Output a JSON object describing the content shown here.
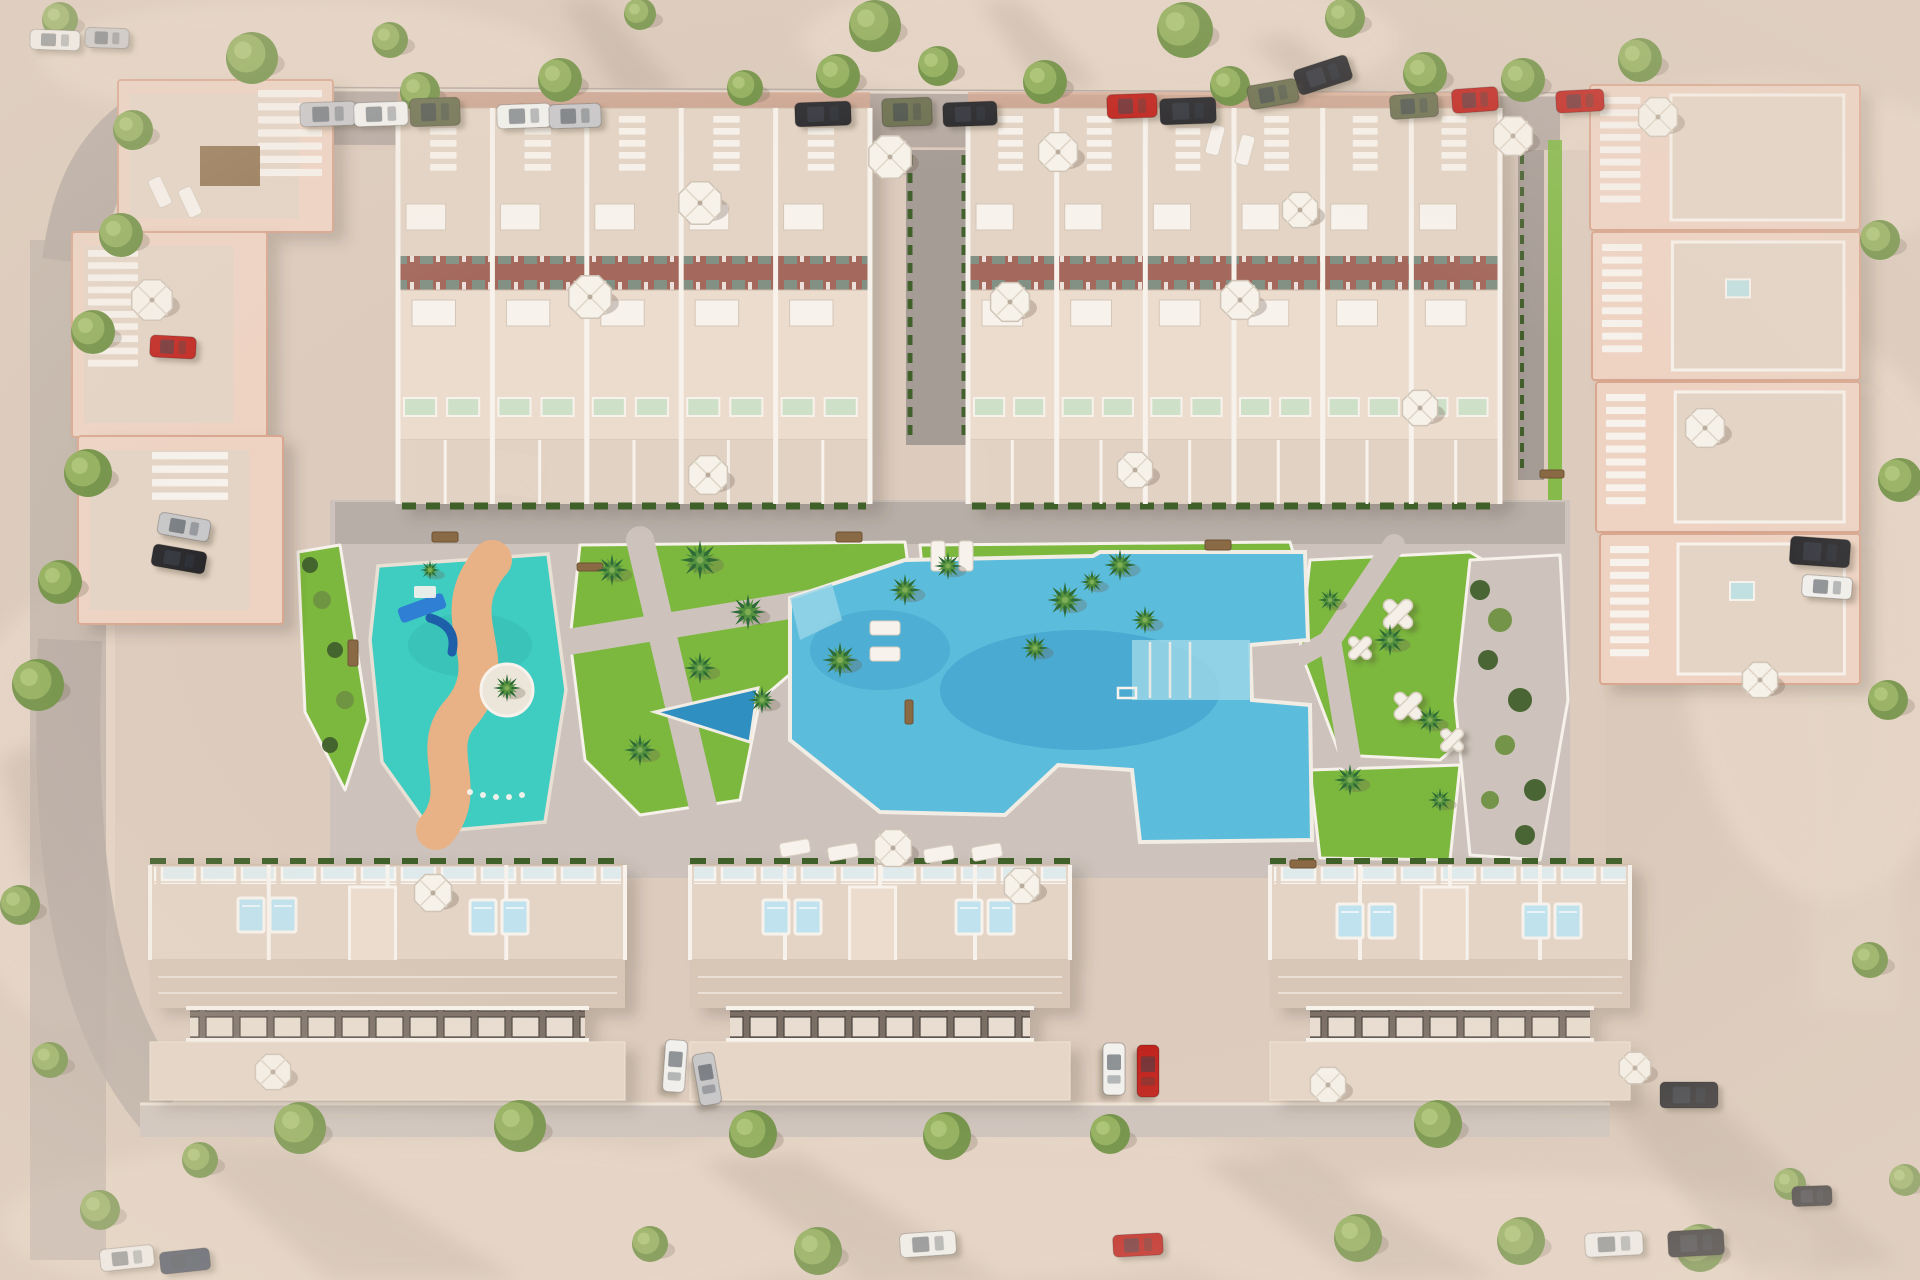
{
  "scene": {
    "title": "Aerial 3D render of a residential development with central pool, kids splash park, lawns and perimeter streets",
    "type": "architectural-visualization",
    "visible_text": ""
  },
  "palette": {
    "sand": "#dbcabb",
    "sand_light": "#ecdccc",
    "road": "#b5a9a2",
    "road_dark": "#a69c96",
    "pavement": "#cdc3bc",
    "block": "#ddccbe",
    "terrace": "#e4d4c5",
    "terrace_light": "#ecdccd",
    "wall": "#eed3c3",
    "wall_edge": "#d9a68f",
    "white": "#f7f2ec",
    "brick": "#a4685c",
    "glass": "#dfeaec",
    "lawn": "#7cb83e",
    "lawn_dark": "#69a431",
    "hedge": "#41602c",
    "bush_light": "#6f9242",
    "pool": "#5cbcdc",
    "pool_dark": "#2f8fc0",
    "pool_light": "#9ad6e8",
    "kids_pool": "#3fccc1",
    "kids_path": "#e9b286",
    "slide": "#2f7fd4",
    "tree": "#8fae58",
    "tree_dark": "#6d8f41",
    "tree_light": "#aac573",
    "planter": "#4d5138",
    "shadow": "#6f6054",
    "wood": "#8a6a45",
    "car_white": "#f2f1ee",
    "car_silver": "#c7c7c9",
    "car_black": "#26262a",
    "car_red": "#c0221c",
    "car_olive": "#6c7050",
    "car_navy": "#3a4558"
  },
  "rowhouse_clusters": [
    {
      "x": 398,
      "y": 108,
      "w": 472,
      "units": 5
    },
    {
      "x": 968,
      "y": 108,
      "w": 532,
      "units": 6
    }
  ],
  "apartment_buildings": [
    {
      "x": 118,
      "y": 80,
      "w": 215,
      "h": 152,
      "stair": [
        258,
        90,
        64,
        92
      ],
      "pergola": [
        200,
        146,
        60,
        40
      ]
    },
    {
      "x": 72,
      "y": 232,
      "w": 195,
      "h": 205,
      "stair": [
        88,
        250,
        50,
        122
      ],
      "pergola": null
    },
    {
      "x": 78,
      "y": 436,
      "w": 205,
      "h": 188,
      "stair": [
        152,
        452,
        76,
        54
      ],
      "pergola": null
    }
  ],
  "side_houses": [
    {
      "x": 1590,
      "y": 85,
      "w": 270,
      "h": 145,
      "skylight": false
    },
    {
      "x": 1592,
      "y": 232,
      "w": 268,
      "h": 148,
      "skylight": true
    },
    {
      "x": 1596,
      "y": 382,
      "w": 264,
      "h": 150,
      "skylight": false
    },
    {
      "x": 1600,
      "y": 534,
      "w": 260,
      "h": 150,
      "skylight": true
    }
  ],
  "bottom_blocks": [
    {
      "x": 150,
      "y": 865,
      "w": 475
    },
    {
      "x": 690,
      "y": 865,
      "w": 380
    },
    {
      "x": 1270,
      "y": 865,
      "w": 360
    }
  ],
  "rooftop_pool_pairs": [
    {
      "x": 238,
      "y": 898
    },
    {
      "x": 470,
      "y": 900
    },
    {
      "x": 763,
      "y": 900
    },
    {
      "x": 956,
      "y": 900
    },
    {
      "x": 1337,
      "y": 904
    },
    {
      "x": 1523,
      "y": 904
    }
  ],
  "trees": [
    {
      "x": 252,
      "y": 58,
      "r": 26
    },
    {
      "x": 390,
      "y": 40,
      "r": 18
    },
    {
      "x": 875,
      "y": 26,
      "r": 26
    },
    {
      "x": 938,
      "y": 66,
      "r": 20
    },
    {
      "x": 1185,
      "y": 30,
      "r": 28
    },
    {
      "x": 1345,
      "y": 18,
      "r": 20
    },
    {
      "x": 640,
      "y": 14,
      "r": 16
    },
    {
      "x": 1640,
      "y": 60,
      "r": 22
    },
    {
      "x": 60,
      "y": 20,
      "r": 18
    },
    {
      "x": 133,
      "y": 130,
      "r": 20
    },
    {
      "x": 420,
      "y": 92,
      "r": 20
    },
    {
      "x": 560,
      "y": 80,
      "r": 22
    },
    {
      "x": 745,
      "y": 88,
      "r": 18
    },
    {
      "x": 838,
      "y": 76,
      "r": 22
    },
    {
      "x": 1045,
      "y": 82,
      "r": 22
    },
    {
      "x": 1230,
      "y": 86,
      "r": 20
    },
    {
      "x": 1425,
      "y": 74,
      "r": 22
    },
    {
      "x": 1523,
      "y": 80,
      "r": 22
    },
    {
      "x": 121,
      "y": 235,
      "r": 22
    },
    {
      "x": 93,
      "y": 332,
      "r": 22
    },
    {
      "x": 88,
      "y": 473,
      "r": 24
    },
    {
      "x": 60,
      "y": 582,
      "r": 22
    },
    {
      "x": 38,
      "y": 685,
      "r": 26
    },
    {
      "x": 20,
      "y": 905,
      "r": 20
    },
    {
      "x": 50,
      "y": 1060,
      "r": 18
    },
    {
      "x": 1880,
      "y": 240,
      "r": 20
    },
    {
      "x": 1900,
      "y": 480,
      "r": 22
    },
    {
      "x": 1888,
      "y": 700,
      "r": 20
    },
    {
      "x": 1870,
      "y": 960,
      "r": 18
    },
    {
      "x": 300,
      "y": 1128,
      "r": 26
    },
    {
      "x": 520,
      "y": 1126,
      "r": 26
    },
    {
      "x": 753,
      "y": 1134,
      "r": 24
    },
    {
      "x": 947,
      "y": 1136,
      "r": 24
    },
    {
      "x": 1110,
      "y": 1134,
      "r": 20
    },
    {
      "x": 1438,
      "y": 1124,
      "r": 24
    },
    {
      "x": 200,
      "y": 1160,
      "r": 18
    },
    {
      "x": 650,
      "y": 1244,
      "r": 18
    },
    {
      "x": 818,
      "y": 1251,
      "r": 24
    },
    {
      "x": 1358,
      "y": 1238,
      "r": 24
    },
    {
      "x": 1521,
      "y": 1241,
      "r": 24
    },
    {
      "x": 1700,
      "y": 1248,
      "r": 24
    },
    {
      "x": 1790,
      "y": 1184,
      "r": 16
    },
    {
      "x": 100,
      "y": 1210,
      "r": 20
    },
    {
      "x": 1905,
      "y": 1180,
      "r": 16
    }
  ],
  "palms": [
    {
      "x": 612,
      "y": 570,
      "r": 16
    },
    {
      "x": 700,
      "y": 560,
      "r": 20
    },
    {
      "x": 748,
      "y": 612,
      "r": 18
    },
    {
      "x": 700,
      "y": 668,
      "r": 16
    },
    {
      "x": 762,
      "y": 700,
      "r": 14
    },
    {
      "x": 640,
      "y": 750,
      "r": 16
    },
    {
      "x": 840,
      "y": 660,
      "r": 18
    },
    {
      "x": 905,
      "y": 590,
      "r": 16
    },
    {
      "x": 948,
      "y": 566,
      "r": 14
    },
    {
      "x": 1120,
      "y": 565,
      "r": 16
    },
    {
      "x": 1065,
      "y": 600,
      "r": 18
    },
    {
      "x": 1035,
      "y": 648,
      "r": 14
    },
    {
      "x": 1092,
      "y": 582,
      "r": 12
    },
    {
      "x": 1145,
      "y": 620,
      "r": 14
    },
    {
      "x": 1390,
      "y": 640,
      "r": 16
    },
    {
      "x": 1430,
      "y": 720,
      "r": 14
    },
    {
      "x": 1350,
      "y": 780,
      "r": 16
    },
    {
      "x": 1440,
      "y": 800,
      "r": 12
    },
    {
      "x": 507,
      "y": 688,
      "r": 14
    },
    {
      "x": 430,
      "y": 570,
      "r": 10
    },
    {
      "x": 1330,
      "y": 600,
      "r": 12
    }
  ],
  "umbrellas": [
    {
      "x": 700,
      "y": 203,
      "r": 23
    },
    {
      "x": 890,
      "y": 157,
      "r": 23
    },
    {
      "x": 1058,
      "y": 152,
      "r": 21
    },
    {
      "x": 1010,
      "y": 302,
      "r": 21
    },
    {
      "x": 590,
      "y": 297,
      "r": 23
    },
    {
      "x": 708,
      "y": 475,
      "r": 21
    },
    {
      "x": 1240,
      "y": 300,
      "r": 21
    },
    {
      "x": 1135,
      "y": 470,
      "r": 19
    },
    {
      "x": 1420,
      "y": 408,
      "r": 19
    },
    {
      "x": 1513,
      "y": 136,
      "r": 21
    },
    {
      "x": 1300,
      "y": 210,
      "r": 19
    },
    {
      "x": 1658,
      "y": 117,
      "r": 21
    },
    {
      "x": 1705,
      "y": 428,
      "r": 21
    },
    {
      "x": 1760,
      "y": 680,
      "r": 19
    },
    {
      "x": 433,
      "y": 893,
      "r": 20
    },
    {
      "x": 1022,
      "y": 886,
      "r": 19
    },
    {
      "x": 893,
      "y": 848,
      "r": 20
    },
    {
      "x": 273,
      "y": 1072,
      "r": 19
    },
    {
      "x": 1328,
      "y": 1085,
      "r": 19
    },
    {
      "x": 1635,
      "y": 1068,
      "r": 17
    },
    {
      "x": 152,
      "y": 300,
      "r": 22
    }
  ],
  "cars": [
    {
      "x": 300,
      "y": 102,
      "w": 56,
      "h": 24,
      "a": -2,
      "c": "silver"
    },
    {
      "x": 354,
      "y": 102,
      "w": 54,
      "h": 24,
      "a": -2,
      "c": "white"
    },
    {
      "x": 410,
      "y": 98,
      "w": 50,
      "h": 28,
      "a": -2,
      "c": "olive"
    },
    {
      "x": 497,
      "y": 104,
      "w": 54,
      "h": 24,
      "a": -2,
      "c": "white"
    },
    {
      "x": 549,
      "y": 104,
      "w": 52,
      "h": 24,
      "a": -2,
      "c": "silver"
    },
    {
      "x": 795,
      "y": 102,
      "w": 56,
      "h": 24,
      "a": -2,
      "c": "black"
    },
    {
      "x": 882,
      "y": 98,
      "w": 50,
      "h": 28,
      "a": -2,
      "c": "olive"
    },
    {
      "x": 943,
      "y": 102,
      "w": 54,
      "h": 24,
      "a": -2,
      "c": "black"
    },
    {
      "x": 1107,
      "y": 94,
      "w": 50,
      "h": 24,
      "a": -2,
      "c": "red"
    },
    {
      "x": 1160,
      "y": 98,
      "w": 56,
      "h": 26,
      "a": -2,
      "c": "black"
    },
    {
      "x": 1295,
      "y": 62,
      "w": 56,
      "h": 26,
      "a": -18,
      "c": "black"
    },
    {
      "x": 1248,
      "y": 82,
      "w": 50,
      "h": 24,
      "a": -10,
      "c": "olive"
    },
    {
      "x": 1390,
      "y": 94,
      "w": 48,
      "h": 24,
      "a": -4,
      "c": "olive"
    },
    {
      "x": 1452,
      "y": 88,
      "w": 46,
      "h": 24,
      "a": -4,
      "c": "red"
    },
    {
      "x": 1556,
      "y": 90,
      "w": 48,
      "h": 22,
      "a": -3,
      "c": "red"
    },
    {
      "x": 30,
      "y": 30,
      "w": 50,
      "h": 20,
      "a": 2,
      "c": "white"
    },
    {
      "x": 85,
      "y": 28,
      "w": 44,
      "h": 20,
      "a": 2,
      "c": "silver"
    },
    {
      "x": 150,
      "y": 336,
      "w": 46,
      "h": 22,
      "a": 3,
      "c": "red"
    },
    {
      "x": 158,
      "y": 516,
      "w": 52,
      "h": 22,
      "a": 10,
      "c": "silver"
    },
    {
      "x": 152,
      "y": 548,
      "w": 54,
      "h": 22,
      "a": 10,
      "c": "black"
    },
    {
      "x": 1790,
      "y": 538,
      "w": 60,
      "h": 28,
      "a": 4,
      "c": "black"
    },
    {
      "x": 1802,
      "y": 576,
      "w": 50,
      "h": 22,
      "a": 4,
      "c": "white"
    },
    {
      "x": 649,
      "y": 1055,
      "w": 52,
      "h": 22,
      "a": 94,
      "c": "white"
    },
    {
      "x": 681,
      "y": 1068,
      "w": 52,
      "h": 22,
      "a": 80,
      "c": "silver"
    },
    {
      "x": 1088,
      "y": 1058,
      "w": 52,
      "h": 22,
      "a": 90,
      "c": "white"
    },
    {
      "x": 1122,
      "y": 1060,
      "w": 52,
      "h": 22,
      "a": 90,
      "c": "red"
    },
    {
      "x": 1660,
      "y": 1082,
      "w": 58,
      "h": 26,
      "a": 0,
      "c": "black"
    },
    {
      "x": 100,
      "y": 1247,
      "w": 54,
      "h": 22,
      "a": -6,
      "c": "white"
    },
    {
      "x": 160,
      "y": 1250,
      "w": 50,
      "h": 22,
      "a": -6,
      "c": "navy"
    },
    {
      "x": 900,
      "y": 1232,
      "w": 56,
      "h": 24,
      "a": -4,
      "c": "white"
    },
    {
      "x": 1113,
      "y": 1234,
      "w": 50,
      "h": 22,
      "a": -3,
      "c": "red"
    },
    {
      "x": 1585,
      "y": 1232,
      "w": 58,
      "h": 24,
      "a": -3,
      "c": "white"
    },
    {
      "x": 1668,
      "y": 1230,
      "w": 56,
      "h": 26,
      "a": -3,
      "c": "black"
    },
    {
      "x": 1792,
      "y": 1186,
      "w": 40,
      "h": 20,
      "a": -2,
      "c": "black"
    }
  ],
  "x_tables": [
    {
      "x": 1398,
      "y": 614,
      "s": 36
    },
    {
      "x": 1360,
      "y": 648,
      "s": 28
    },
    {
      "x": 1408,
      "y": 706,
      "s": 34
    },
    {
      "x": 1452,
      "y": 740,
      "s": 28
    }
  ],
  "loungers": [
    {
      "x": 795,
      "y": 848,
      "a": 80
    },
    {
      "x": 843,
      "y": 852,
      "a": 80
    },
    {
      "x": 891,
      "y": 854,
      "a": 80
    },
    {
      "x": 939,
      "y": 854,
      "a": 80
    },
    {
      "x": 987,
      "y": 852,
      "a": 80
    },
    {
      "x": 938,
      "y": 556,
      "a": 0
    },
    {
      "x": 966,
      "y": 556,
      "a": 0
    },
    {
      "x": 885,
      "y": 628,
      "a": 90
    },
    {
      "x": 885,
      "y": 654,
      "a": 90
    },
    {
      "x": 160,
      "y": 192,
      "a": -25
    },
    {
      "x": 190,
      "y": 202,
      "a": -25
    },
    {
      "x": 1215,
      "y": 140,
      "a": 15
    },
    {
      "x": 1245,
      "y": 150,
      "a": 15
    }
  ],
  "benches": [
    {
      "x": 432,
      "y": 532,
      "w": 26,
      "h": 10
    },
    {
      "x": 836,
      "y": 532,
      "w": 26,
      "h": 10
    },
    {
      "x": 1205,
      "y": 540,
      "w": 26,
      "h": 10
    },
    {
      "x": 348,
      "y": 640,
      "w": 10,
      "h": 26
    },
    {
      "x": 577,
      "y": 563,
      "w": 26,
      "h": 8
    },
    {
      "x": 905,
      "y": 700,
      "w": 8,
      "h": 24
    },
    {
      "x": 1290,
      "y": 860,
      "w": 26,
      "h": 8
    },
    {
      "x": 1540,
      "y": 470,
      "w": 24,
      "h": 8
    }
  ],
  "bushes": [
    {
      "x": 1480,
      "y": 590,
      "r": 10,
      "t": "d"
    },
    {
      "x": 1500,
      "y": 620,
      "r": 12,
      "t": "l"
    },
    {
      "x": 1488,
      "y": 660,
      "r": 10,
      "t": "d"
    },
    {
      "x": 1520,
      "y": 700,
      "r": 12,
      "t": "d"
    },
    {
      "x": 1505,
      "y": 745,
      "r": 10,
      "t": "l"
    },
    {
      "x": 1535,
      "y": 790,
      "r": 11,
      "t": "d"
    },
    {
      "x": 1490,
      "y": 800,
      "r": 9,
      "t": "l"
    },
    {
      "x": 1525,
      "y": 835,
      "r": 10,
      "t": "d"
    },
    {
      "x": 310,
      "y": 565,
      "r": 8,
      "t": "d"
    },
    {
      "x": 322,
      "y": 600,
      "r": 9,
      "t": "l"
    },
    {
      "x": 335,
      "y": 650,
      "r": 8,
      "t": "d"
    },
    {
      "x": 345,
      "y": 700,
      "r": 9,
      "t": "l"
    },
    {
      "x": 330,
      "y": 745,
      "r": 8,
      "t": "d"
    }
  ],
  "sprinkles": [
    {
      "x": 470,
      "y": 792
    },
    {
      "x": 483,
      "y": 795
    },
    {
      "x": 496,
      "y": 797
    },
    {
      "x": 509,
      "y": 797
    },
    {
      "x": 522,
      "y": 795
    }
  ]
}
